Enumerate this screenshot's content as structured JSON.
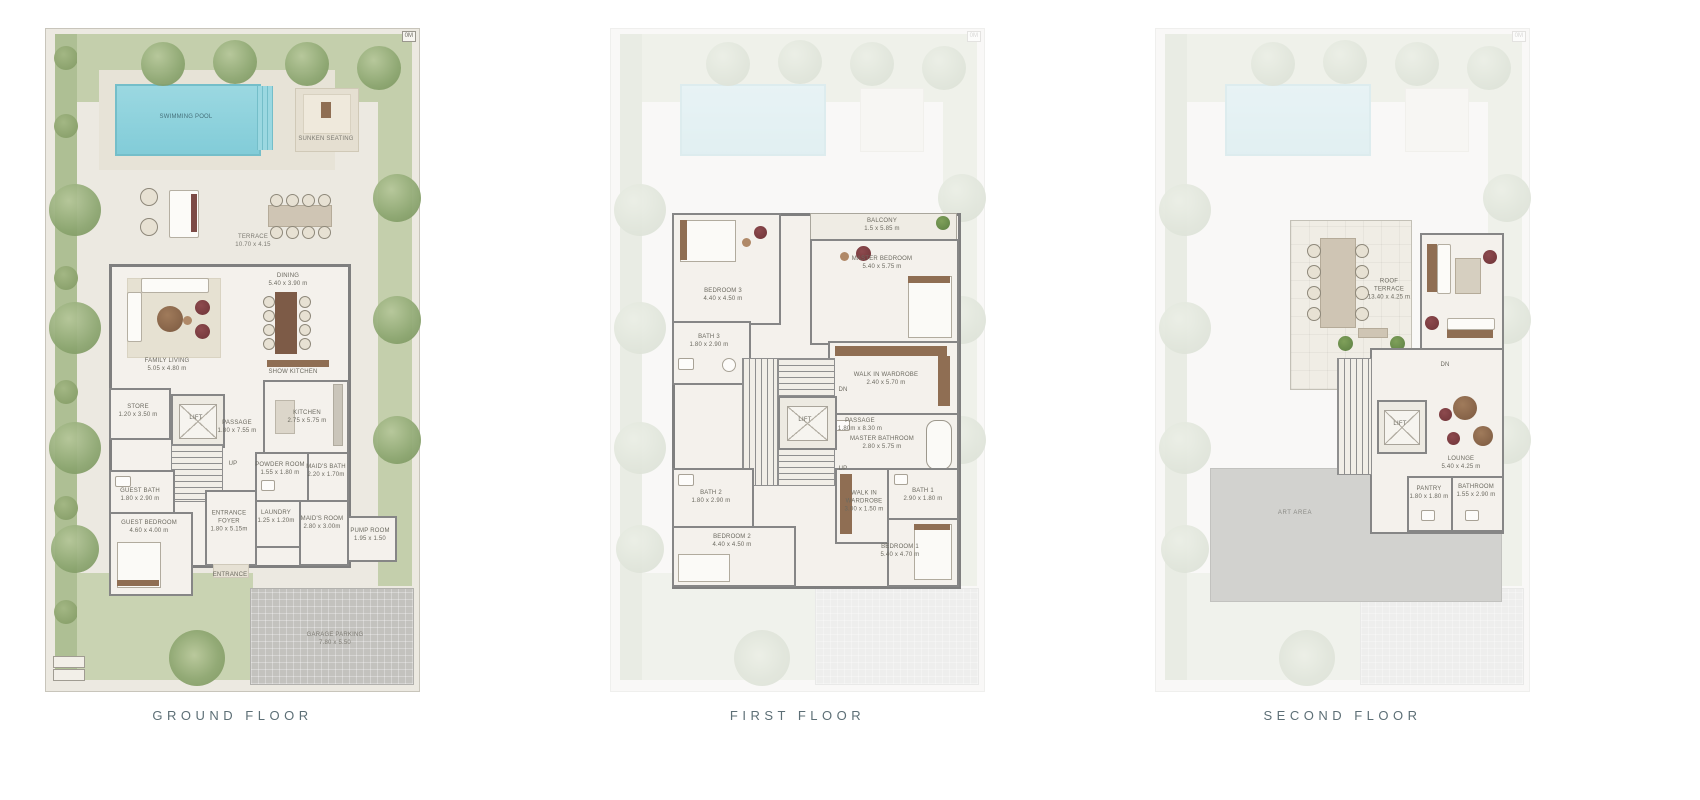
{
  "captions": {
    "ground": "GROUND FLOOR",
    "first": "FIRST FLOOR",
    "second": "SECOND FLOOR"
  },
  "scale_marker": "0M",
  "colors": {
    "pool": "#8ad2de",
    "lawn": "#c4cfac",
    "wall": "#868686",
    "floor": "#f4f1ec",
    "accent_chair": "#7c3c40"
  },
  "site": {
    "pool": "SWIMMING POOL",
    "sunken": "SUNKEN SEATING",
    "terrace": "TERRACE",
    "terrace_dims": "10.70 x 4.15",
    "garage": "GARAGE PARKING",
    "garage_dims": "7.80 x 5.50"
  },
  "ground": {
    "rooms": {
      "family_living": {
        "n": "FAMILY LIVING",
        "d": "5.05 x 4.80 m"
      },
      "dining": {
        "n": "DINING",
        "d": "5.40 x 3.90 m"
      },
      "show_kitchen": {
        "n": "SHOW KITCHEN",
        "d": ""
      },
      "store": {
        "n": "STORE",
        "d": "1.20 x 3.50 m"
      },
      "lift": {
        "n": "LIFT",
        "d": ""
      },
      "passage": {
        "n": "PASSAGE",
        "d": "1.80 x 7.55 m"
      },
      "kitchen": {
        "n": "KITCHEN",
        "d": "2.75 x 5.75 m"
      },
      "powder": {
        "n": "POWDER ROOM",
        "d": "1.55 x 1.80 m"
      },
      "maids_bath": {
        "n": "MAID'S BATH",
        "d": "2.20 x 1.70m"
      },
      "guest_bath": {
        "n": "GUEST BATH",
        "d": "1.80 x 2.90 m"
      },
      "guest_bedroom": {
        "n": "GUEST BEDROOM",
        "d": "4.60 x 4.00 m"
      },
      "entrance_foyer": {
        "n": "ENTRANCE FOYER",
        "d": "1.80 x 5.15m"
      },
      "laundry": {
        "n": "LAUNDRY",
        "d": "1.25 x 1.20m"
      },
      "maids_room": {
        "n": "MAID'S ROOM",
        "d": "2.80 x 3.00m"
      },
      "pump": {
        "n": "PUMP ROOM",
        "d": "1.95 x 1.50"
      },
      "entrance": {
        "n": "ENTRANCE",
        "d": ""
      },
      "up": "UP"
    }
  },
  "first": {
    "rooms": {
      "bedroom3": {
        "n": "BEDROOM 3",
        "d": "4.40 x 4.50 m"
      },
      "balcony": {
        "n": "BALCONY",
        "d": "1.5 x 5.85 m"
      },
      "master_bedroom": {
        "n": "MASTER BEDROOM",
        "d": "5.40 x 5.75 m"
      },
      "bath3": {
        "n": "BATH 3",
        "d": "1.80 x 2.90 m"
      },
      "wiw_master": {
        "n": "WALK IN WARDROBE",
        "d": "2.40 x 5.70 m"
      },
      "master_bath": {
        "n": "MASTER BATHROOM",
        "d": "2.80 x 5.75 m"
      },
      "lift": {
        "n": "LIFT",
        "d": ""
      },
      "passage": {
        "n": "PASSAGE",
        "d": "1.80m x 8.30 m"
      },
      "bath2": {
        "n": "BATH 2",
        "d": "1.80 x 2.90 m"
      },
      "bedroom2": {
        "n": "BEDROOM 2",
        "d": "4.40 x 4.50 m"
      },
      "wiw1": {
        "n": "WALK IN WARDROBE",
        "d": "3.00 x 1.50 m"
      },
      "bath1": {
        "n": "BATH 1",
        "d": "2.90 x 1.80 m"
      },
      "bedroom1": {
        "n": "BEDROOM 1",
        "d": "5.40 x 4.70 m"
      },
      "dn": "DN",
      "up": "UP"
    }
  },
  "second": {
    "rooms": {
      "roof_terrace": {
        "n": "ROOF TERRACE",
        "d": "13.40 x 4.25 m"
      },
      "lounge": {
        "n": "LOUNGE",
        "d": "5.40 x 4.25 m"
      },
      "pantry": {
        "n": "PANTRY",
        "d": "1.80 x 1.80 m"
      },
      "bathroom": {
        "n": "BATHROOM",
        "d": "1.55 x 2.90 m"
      },
      "lift": {
        "n": "LIFT",
        "d": ""
      },
      "art_area": {
        "n": "ART AREA",
        "d": ""
      },
      "dn": "DN"
    }
  }
}
